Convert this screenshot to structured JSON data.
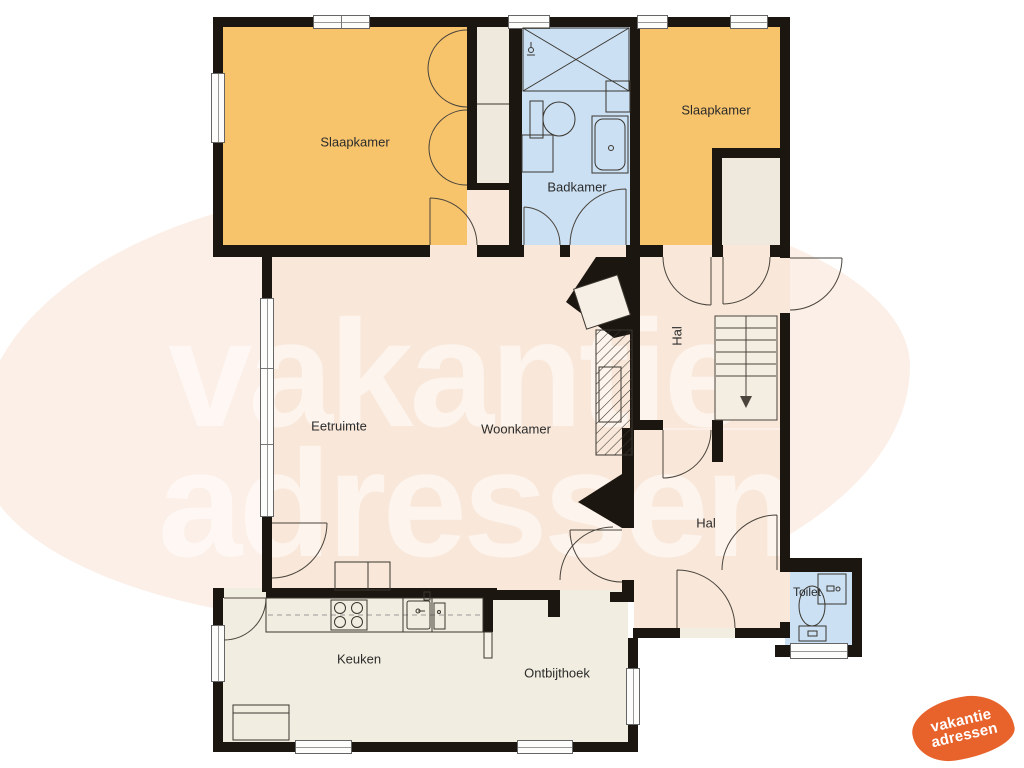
{
  "title": "Floor plan (begane grond) - vakantieadressen",
  "rooms": [
    {
      "id": "slaapkamer-1",
      "label": "Slaapkamer"
    },
    {
      "id": "badkamer",
      "label": "Badkamer"
    },
    {
      "id": "slaapkamer-2",
      "label": "Slaapkamer"
    },
    {
      "id": "hal-boven",
      "label": "Hal"
    },
    {
      "id": "eetruimte",
      "label": "Eetruimte"
    },
    {
      "id": "woonkamer",
      "label": "Woonkamer"
    },
    {
      "id": "hal-beneden",
      "label": "Hal"
    },
    {
      "id": "keuken",
      "label": "Keuken"
    },
    {
      "id": "ontbijthoek",
      "label": "Ontbijthoek"
    },
    {
      "id": "toilet",
      "label": "Toilet"
    }
  ],
  "stairs": {
    "direction_arrow": "down"
  },
  "watermark": {
    "line1": "vakantie",
    "line2": "adressen"
  },
  "logo": {
    "line1": "vakantie",
    "line2": "adressen"
  },
  "icons": {
    "shower": "crossed-box",
    "toilet-fixture": "wc",
    "bathtub": "tub",
    "sink": "basin",
    "hob": "four-burner-stove",
    "stairs": "staircase-down-arrow",
    "chimney": "hatched-flue"
  },
  "colors": {
    "wall": "#1c1610",
    "orange": "#f7c46c",
    "blue": "#cbe0f3",
    "floor-warm": "#f9e8da",
    "floor-light": "#f1ede0",
    "closet": "#efe9dd",
    "accent": "#e8632c",
    "blob": "#fbece3",
    "line": "#4a443c",
    "label": "#2b2b2b"
  }
}
